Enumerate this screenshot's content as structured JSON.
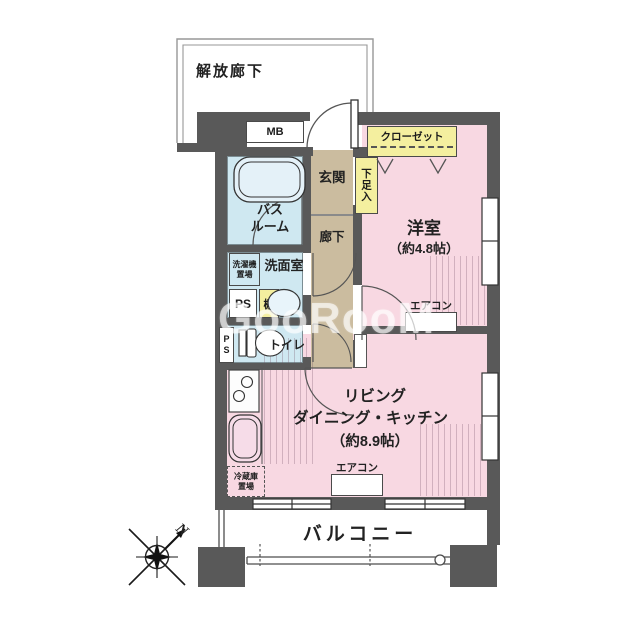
{
  "watermark": "GooRooM",
  "compass": {
    "n": "N"
  },
  "exterior": {
    "open_corridor": "解放廊下",
    "balcony": "バルコニー"
  },
  "rooms": {
    "entrance": "玄関",
    "corridor": "廊下",
    "bath": {
      "l1": "バス",
      "l2": "ルーム"
    },
    "washroom": "洗面室",
    "toilet": "トイレ",
    "western": {
      "name": "洋室",
      "size": "（約4.8帖）"
    },
    "ldk": {
      "l1": "リビング",
      "l2": "ダイニング・キッチン",
      "l3": "（約8.9帖）"
    }
  },
  "fixtures": {
    "mb": "MB",
    "ps": "PS",
    "shelf": "棚",
    "shoe_box": "下足入",
    "closet": "クローゼット",
    "washer": {
      "l1": "洗濯機",
      "l2": "置場"
    },
    "fridge": {
      "l1": "冷蔵庫",
      "l2": "置場"
    },
    "aircon": "エアコン"
  },
  "colors": {
    "wall": "#595959",
    "room_pink": "#f8d8e2",
    "room_tan": "#cbbc9f",
    "room_blue": "#cfe8f1",
    "accent_yellow": "#f4ef9f"
  }
}
